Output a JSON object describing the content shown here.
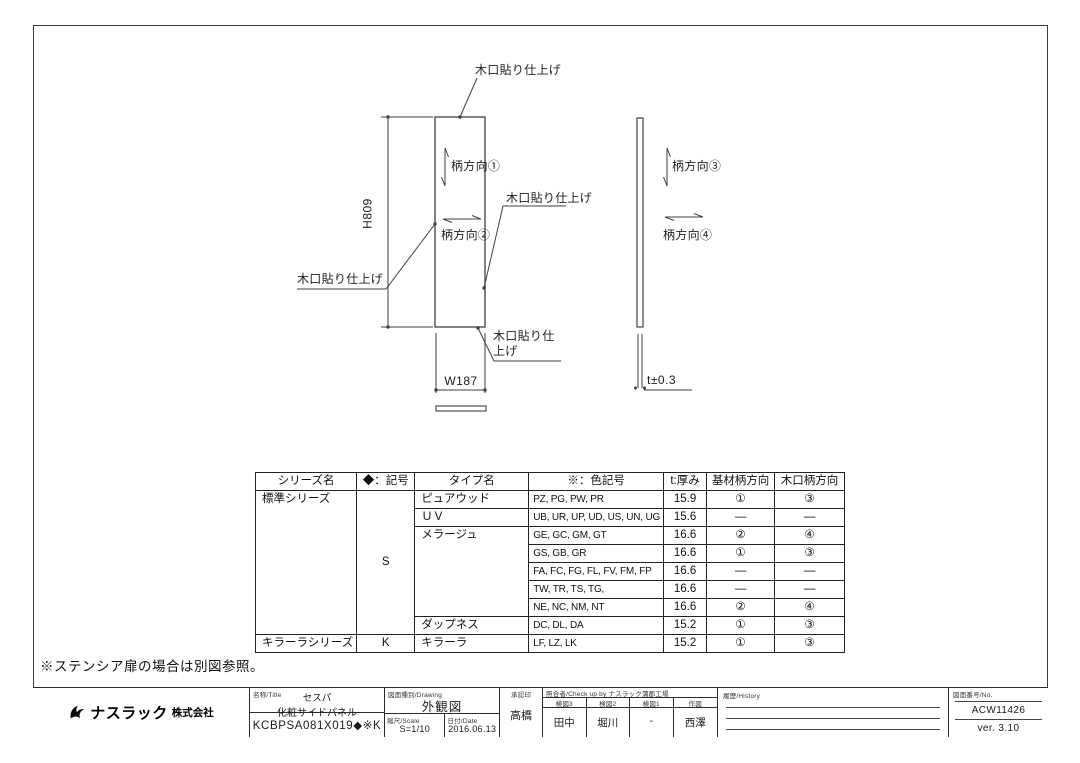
{
  "colors": {
    "line": "#3f3f3f",
    "text": "#1a1a1a",
    "border": "#2b2b2b"
  },
  "diagram": {
    "front_view": {
      "label_edge_top": "木口貼り仕上げ",
      "label_grain_vertical": "柄方向①",
      "label_grain_horizontal": "柄方向②",
      "label_edge_right": "木口貼り仕上げ",
      "label_edge_left": "木口貼り仕上げ",
      "label_edge_bottom": "木口貼り仕上げ",
      "dim_height": "H809",
      "dim_width": "W187"
    },
    "side_view": {
      "label_grain_vertical": "柄方向③",
      "label_grain_horizontal": "柄方向④",
      "dim_thickness": "t±0.3"
    }
  },
  "spec_table": {
    "headers": [
      "シリーズ名",
      "◆：記号",
      "タイプ名",
      "※：色記号",
      "t:厚み",
      "基材柄方向",
      "木口柄方向"
    ],
    "rows": [
      [
        "標準シリーズ",
        "S",
        "ピュアウッド",
        "PZ, PG, PW, PR",
        "15.9",
        "①",
        "③"
      ],
      [
        "",
        "",
        "ＵＶ",
        "UB, UR, UP, UD, US, UN, UG",
        "15.6",
        "―",
        "―"
      ],
      [
        "",
        "",
        "メラージュ",
        "GE, GC, GM, GT",
        "16.6",
        "②",
        "④"
      ],
      [
        "",
        "",
        "",
        "GS, GB, GR",
        "16.6",
        "①",
        "③"
      ],
      [
        "",
        "",
        "",
        "FA, FC, FG, FL, FV, FM, FP",
        "16.6",
        "―",
        "―"
      ],
      [
        "",
        "",
        "",
        "TW, TR, TS, TG,",
        "16.6",
        "―",
        "―"
      ],
      [
        "",
        "",
        "",
        "NE, NC, NM, NT",
        "16.6",
        "②",
        "④"
      ],
      [
        "",
        "",
        "ダップネス",
        "DC, DL, DA",
        "15.2",
        "①",
        "③"
      ],
      [
        "キラーラシリーズ",
        "K",
        "キラーラ",
        "LF, LZ, LK",
        "15.2",
        "①",
        "③"
      ]
    ]
  },
  "note": "※ステンシア扉の場合は別図参照。",
  "title_block": {
    "company": "ナスラック",
    "company_suffix": "株式会社",
    "title_label": "名称/Title",
    "product_line1": "セスパ",
    "product_line2": "化粧サイドパネル",
    "part_number": "KCBPSA081X019◆※K",
    "drawing_type_label": "図面種別/Drawing",
    "drawing_type": "外観図",
    "scale_label": "縮尺/Scale",
    "scale": "S=1/10",
    "date_label": "日付/Date",
    "date": "2016.06.13",
    "approval_label": "承認印",
    "approval_name": "高橋",
    "check_label": "照合者/Check up by ナスラック蒲郡工場",
    "check_columns": [
      {
        "label": "検図3",
        "name": "田中"
      },
      {
        "label": "検図2",
        "name": "堀川"
      },
      {
        "label": "検図1",
        "name": "-"
      },
      {
        "label": "作図",
        "name": "西澤"
      }
    ],
    "history_label": "履歴/History",
    "number_label": "図面番号/No.",
    "drawing_number": "ACW11426",
    "version": "ver. 3.10"
  }
}
